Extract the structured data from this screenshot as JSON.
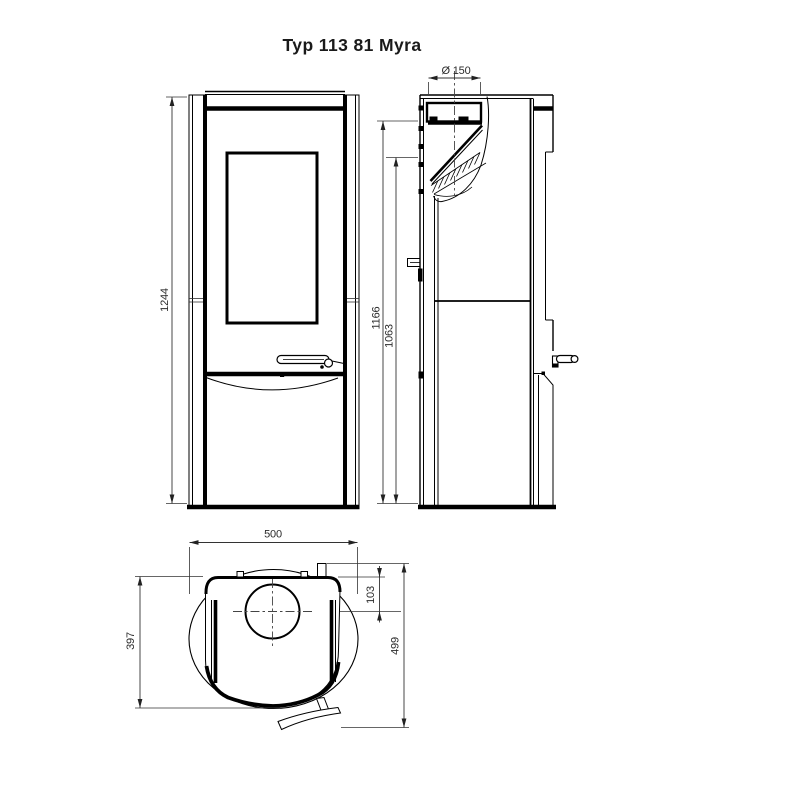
{
  "title": "Typ 113 81 Myra",
  "colors": {
    "line": "#000000",
    "dimension_line": "#333333",
    "text": "#2b2b2b",
    "background": "#ffffff"
  },
  "views": {
    "front": {
      "label": "front view",
      "dimensions": {
        "overall_height": "1244"
      }
    },
    "side": {
      "label": "side view",
      "dimensions": {
        "flue_diameter": "Ø 150",
        "flue_top_height": "1166",
        "flue_center_height": "1063"
      }
    },
    "top": {
      "label": "top view",
      "dimensions": {
        "overall_width": "500",
        "flue_center_from_back": "103",
        "top_plate_depth": "397",
        "overall_depth": "499"
      }
    }
  }
}
